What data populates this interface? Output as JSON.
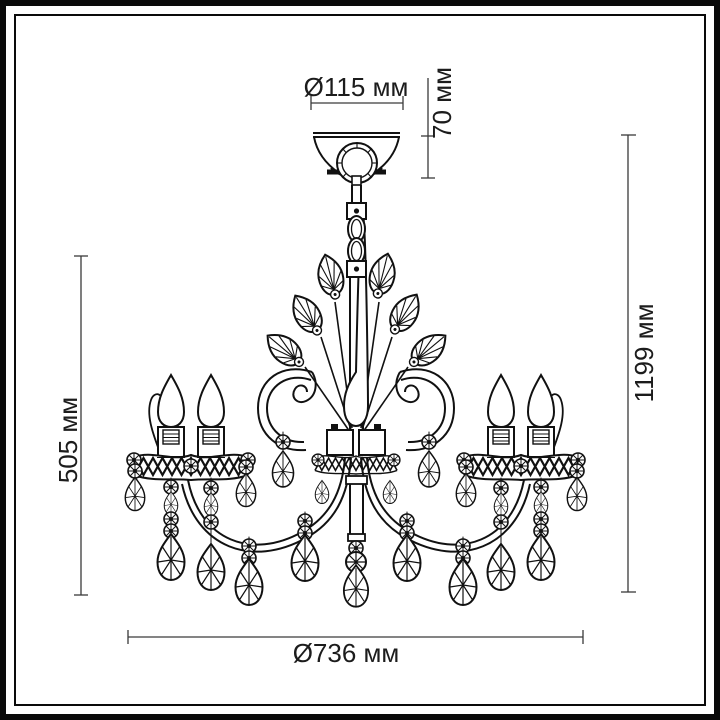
{
  "drawing": {
    "title": "chandelier-dimension-diagram",
    "product_type": "5-light crystal chandelier line drawing",
    "colors": {
      "line": "#111111",
      "dim_line": "#3a3a3a",
      "background": "#ffffff",
      "frame": "#0a0a0a"
    },
    "dimensions": {
      "canopy_diameter": "Ø115 мм",
      "canopy_height": "70 мм",
      "overall_height": "1199 мм",
      "body_height": "505 мм",
      "overall_diameter": "Ø736 мм"
    }
  }
}
